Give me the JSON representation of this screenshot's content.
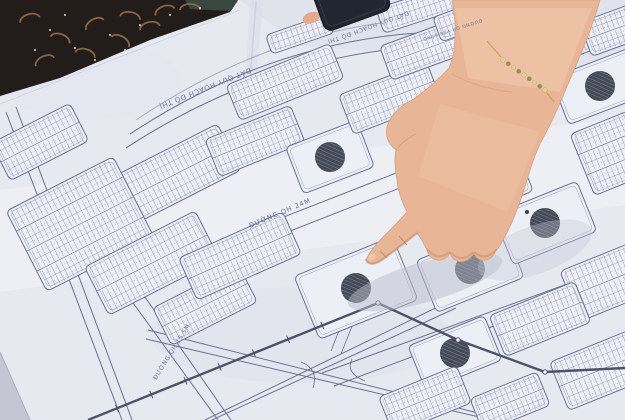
{
  "scene": {
    "alt": "Photograph of a hand pointing at a printed urban land-use planning map spread on a table"
  },
  "map": {
    "labels": {
      "zone_title_1": "ĐẤT QUY HOẠCH ĐÔ THỊ",
      "zone_title_2": "ĐẤT QUY HOẠCH ĐÔ THỊ",
      "road_main": "ĐƯỜNG QH 24M",
      "road_side": "ĐƯỜNG QH 15.5M",
      "road_river": "ĐƯỜNG QH VEN SÔNG"
    },
    "colors": {
      "paper": "#e7e9f1",
      "block_fill": "#edeff6",
      "ink": "#6a7090",
      "ink_strong": "#4e5268",
      "ink_faint": "#9ba0ba",
      "circle_fill": "#454a57",
      "circle_hatch": "#7b8090",
      "label_text": "#6d739a"
    }
  },
  "foreground": {
    "hand": {
      "skin": "#e8b596",
      "skin_light": "#f5d0b6",
      "skin_shadow": "#c08767"
    },
    "bracelet": {
      "gold": "#c9a35f",
      "bead_light": "#e3cf9d",
      "bead_dark": "#9d8a5b"
    },
    "phone": {
      "body": "#222630"
    },
    "fabric": {
      "base": "#221d1b",
      "accent": "#9c7049",
      "speck": "#d9c9ae"
    }
  }
}
